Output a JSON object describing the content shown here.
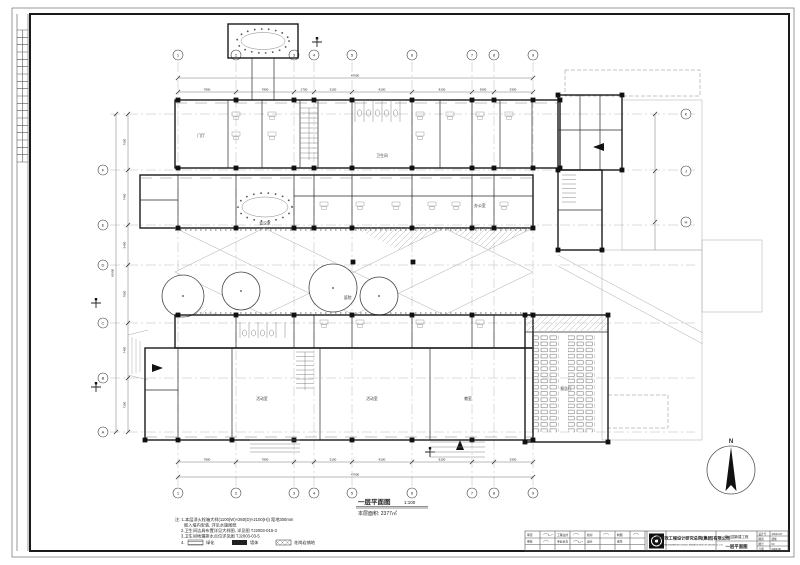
{
  "sheet": {
    "plan_title": "一层平面图",
    "plan_scale": "1:100",
    "plan_area": "本层面积: 2377㎡",
    "north_label": "N",
    "courtyard_label": "庭院"
  },
  "notes": {
    "l1": "注: 1.本层消火栓箱大样(1100(W)×260(D)×2100(H)) 距地300mm",
    "l2": "嵌入墙内安装, 详见水施图纸",
    "l3": "2.卫生间洁具布置详见大样图, 详见图 TJ2003-015-3",
    "l4": "3.卫生间地漏排水点位详见图 TJ2003-03-5",
    "l5": "4.",
    "legend": [
      {
        "label": "绿化"
      },
      {
        "label": "墙体"
      },
      {
        "label": "花岗岩铺地"
      }
    ]
  },
  "grid": {
    "top": [
      "1",
      "2",
      "3",
      "4",
      "5",
      "6",
      "7",
      "8",
      "9"
    ],
    "bottom": [
      "1",
      "2",
      "3",
      "4",
      "5",
      "6",
      "7",
      "8",
      "9"
    ],
    "left": [
      "F",
      "E",
      "D",
      "C",
      "B",
      "A"
    ],
    "right": [
      "K",
      "J",
      "H"
    ]
  },
  "dims": {
    "top": [
      "7800",
      "7800",
      "2700",
      "5100",
      "8100",
      "8100",
      "3000",
      "5300"
    ],
    "top_total": "47900",
    "left": [
      "7600",
      "7400",
      "5400",
      "7800",
      "7400",
      "7300"
    ],
    "left_total": "42900",
    "bottom_total": "47900"
  },
  "rooms": {
    "lobby": "门厅",
    "meeting": "会议室",
    "wc": "卫生间",
    "office": "办公室",
    "activity1": "活动室",
    "activity2": "活动室",
    "classroom": "教室",
    "hall": "报告厅"
  },
  "title_block": {
    "company_cn": "上海市政工程设计研究总院(集团)有限公司",
    "company_en": "SHANGHAI ENGINEERING DESIGN & RESEARCH INSTITUTE (GROUP) CO., LTD.",
    "project": "幼儿园新建工程",
    "sheet_name": "一层平面图",
    "signs": [
      "审定",
      "审核",
      "工程主持",
      "专业负责",
      "校对",
      "设计",
      "制图",
      "会签"
    ],
    "fields": [
      {
        "label": "设计号",
        "value": "2009-317"
      },
      {
        "label": "图别",
        "value": "建施"
      },
      {
        "label": "图号",
        "value": "03"
      },
      {
        "label": "日期",
        "value": "2009.06"
      }
    ]
  }
}
